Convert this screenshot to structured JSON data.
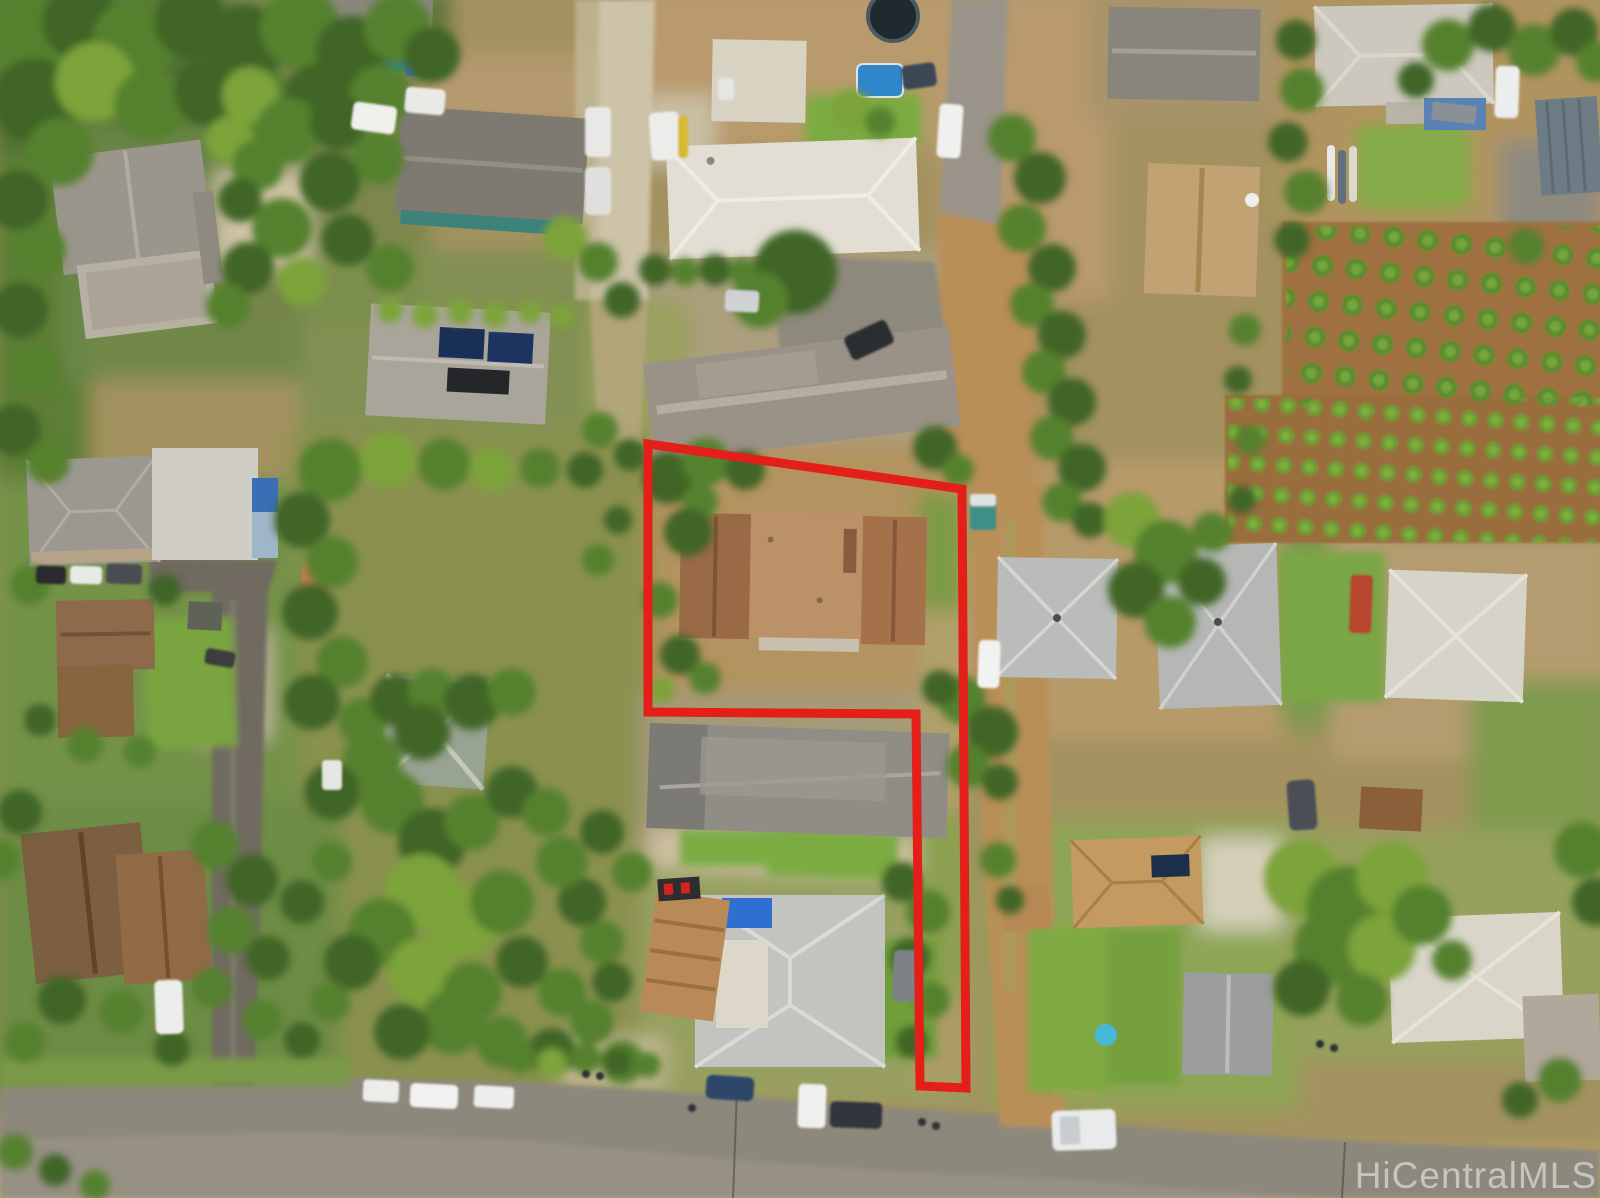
{
  "image": {
    "kind": "aerial-drone-photo",
    "subject": "residential neighborhood with outlined flag lot",
    "width_px": 1600,
    "height_px": 1198
  },
  "watermark": {
    "text": "HiCentralMLS",
    "color": "#e9e9e9"
  },
  "parcel": {
    "name": "subject-property-boundary",
    "boundary_color": "#e41f1a",
    "shape": "flag-lot"
  },
  "palette": {
    "asphalt": "#8d887b",
    "concrete": "#cdc3a8",
    "dirt_road": "#b98f58",
    "dry_soil": "#b3935f",
    "scrub_green": "#8a9150",
    "lawn_green": "#76a53f",
    "tree_dark": "#3f6526",
    "subject_roof_brown": "#a4714b",
    "gravel_roof_gray": "#8f8d86",
    "white_roof": "#e2ded3",
    "farm_soil": "#a0713f",
    "crop_green": "#6f9a35",
    "tarp_blue": "#2f6fd0",
    "pool_blue": "#2f86c8"
  }
}
